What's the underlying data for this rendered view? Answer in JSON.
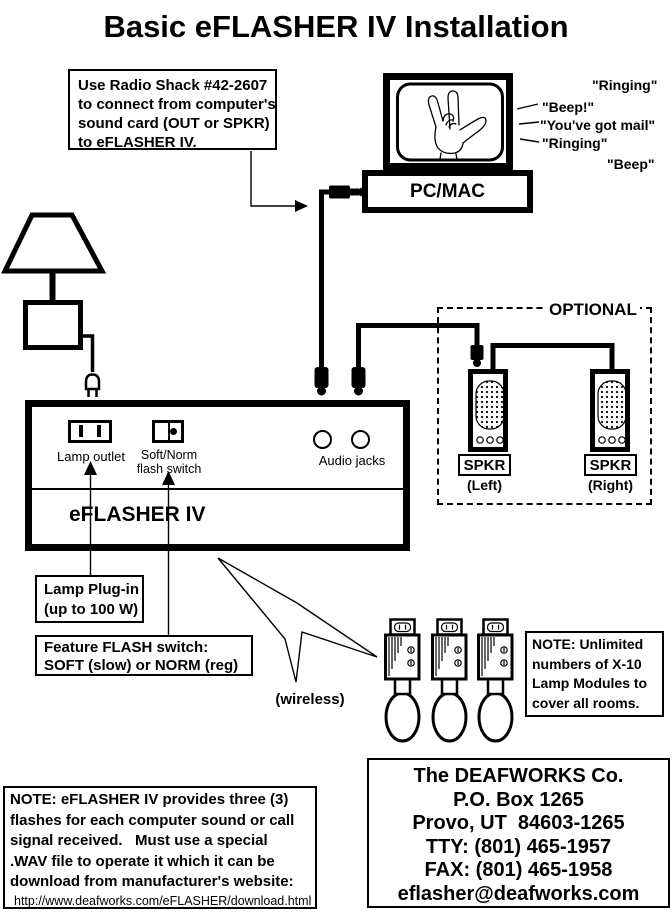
{
  "title": "Basic eFLASHER IV Installation",
  "colors": {
    "ink": "#000000",
    "paper": "#ffffff"
  },
  "radio_note": {
    "line1": "Use Radio Shack #42-2607",
    "line2": "to connect from computer's",
    "line3": "sound card (OUT or SPKR)",
    "line4": "to eFLASHER IV."
  },
  "computer": {
    "label": "PC/MAC",
    "sound1": "\"Ringing\"",
    "sound2": "\"Beep!\"",
    "sound3": "\"You've got mail\"",
    "sound4": "\"Ringing\"",
    "sound5": "\"Beep\""
  },
  "optional": {
    "label": "OPTIONAL",
    "spkr_left": "SPKR",
    "spkr_left_pos": "(Left)",
    "spkr_right": "SPKR",
    "spkr_right_pos": "(Right)"
  },
  "eflasher": {
    "name": "eFLASHER IV",
    "lamp_outlet": "Lamp outlet",
    "switch_line1": "Soft/Norm",
    "switch_line2": "flash switch",
    "audio_jacks": "Audio jacks"
  },
  "lamp_note": {
    "line1": "Lamp Plug-in",
    "line2": "(up to 100 W)"
  },
  "flash_note": {
    "line1": "Feature FLASH switch:",
    "line2": "SOFT (slow) or NORM (reg)"
  },
  "wireless_label": "(wireless)",
  "x10_note": {
    "line1": "NOTE: Unlimited",
    "line2": "numbers of X-10",
    "line3": "Lamp Modules to",
    "line4": "cover all rooms."
  },
  "bottom_note": {
    "line1": "NOTE: eFLASHER IV provides three (3)",
    "line2": "flashes for each computer sound or call",
    "line3": "signal received.   Must use a special",
    "line4": ".WAV file to operate it which it can be",
    "line5": "download from manufacturer's website:",
    "url": "http://www.deafworks.com/eFLASHER/download.html"
  },
  "contact": {
    "line1": "The DEAFWORKS Co.",
    "line2": "P.O. Box 1265",
    "line3": "Provo, UT  84603-1265",
    "line4": "TTY: (801) 465-1957",
    "line5": "FAX: (801) 465-1958",
    "line6": "eflasher@deafworks.com"
  }
}
